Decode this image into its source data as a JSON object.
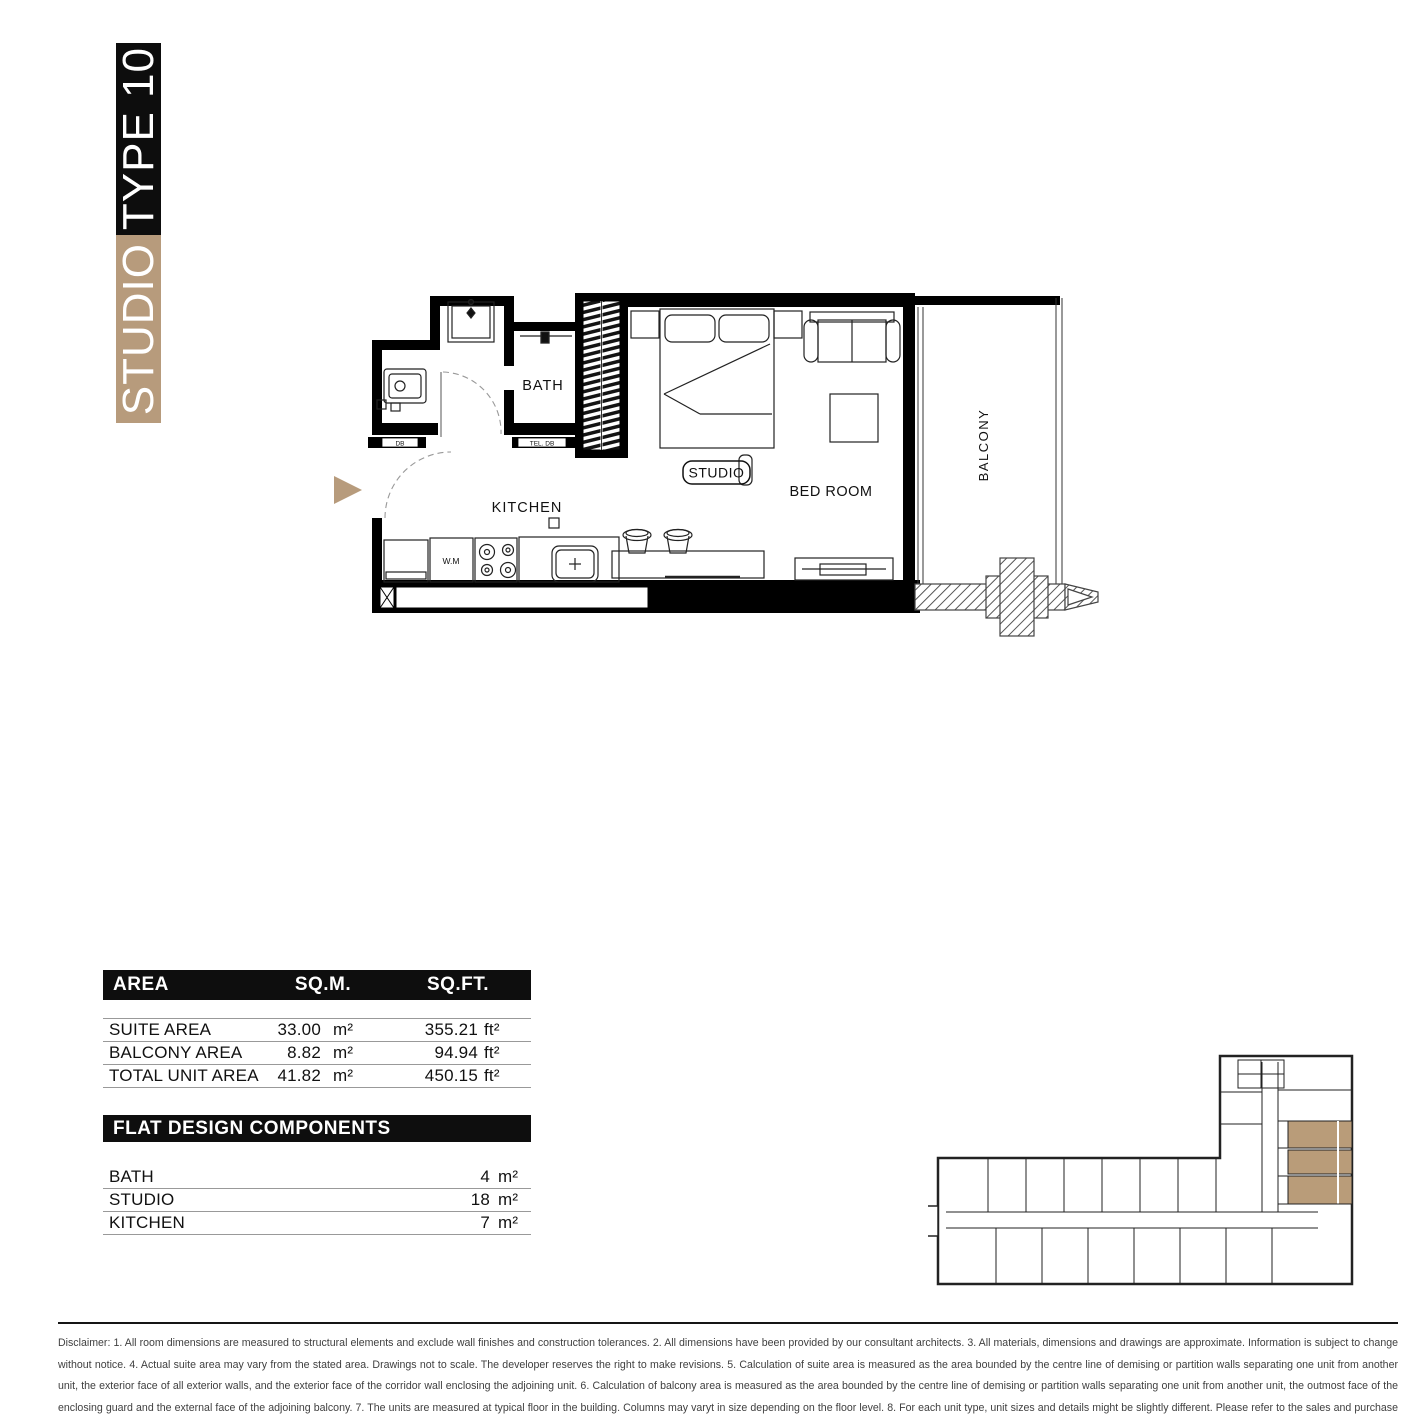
{
  "banner": {
    "top_label": "TYPE 10",
    "bottom_label": "STUDIO"
  },
  "colors": {
    "accent_tan": "#b79b7c",
    "keyplan_highlight": "#b99c79",
    "bar_black": "#0e0e0e"
  },
  "plan": {
    "labels": {
      "bath": "BATH",
      "kitchen": "KITCHEN",
      "studio": "STUDIO",
      "bedroom": "BED ROOM",
      "balcony": "BALCONY",
      "db": "DB",
      "tel_db": "TEL. DB",
      "wm": "W.M"
    }
  },
  "area_table": {
    "header": {
      "area": "AREA",
      "sqm": "SQ.M.",
      "sqft": "SQ.FT."
    },
    "rows": [
      {
        "label": "SUITE AREA",
        "sqm": "33.00",
        "sqm_unit": "m²",
        "sqft": "355.21",
        "sqft_unit": "ft²"
      },
      {
        "label": "BALCONY AREA",
        "sqm": "8.82",
        "sqm_unit": "m²",
        "sqft": "94.94",
        "sqft_unit": "ft²"
      },
      {
        "label": "TOTAL UNIT AREA",
        "sqm": "41.82",
        "sqm_unit": "m²",
        "sqft": "450.15",
        "sqft_unit": "ft²"
      }
    ]
  },
  "components": {
    "title": "FLAT DESIGN COMPONENTS",
    "rows": [
      {
        "label": "BATH",
        "value": "4",
        "unit": "m²"
      },
      {
        "label": "STUDIO",
        "value": "18",
        "unit": "m²"
      },
      {
        "label": "KITCHEN",
        "value": "7",
        "unit": "m²"
      }
    ]
  },
  "disclaimer": {
    "text": "Disclaimer: 1. All room dimensions are measured to structural elements and exclude wall finishes and construction tolerances. 2. All dimensions have been provided by our consultant architects. 3. All materials, dimensions and drawings are approximate. Information is subject to change without notice. 4. Actual suite area may vary from the stated area. Drawings not to scale. The developer reserves the right to make revisions. 5. Calculation of suite area is measured as the area bounded by the centre line of demising or partition walls separating one unit from another unit, the exterior face of all exterior walls, and the exterior face of the corridor wall enclosing the adjoining unit. 6. Calculation of balcony area is measured as the area bounded by the centre line of demising or partition walls separating one unit from another unit, the outmost face of the enclosing guard and the external face of the adjoining balcony. 7. The units are measured at typical floor in the building. Columns may varyt in size depending on the floor level. 8. For each unit type, unit sizes and details might be slightly different. Please refer to the sales and purchase agreement for the actual size of each specific unit."
  }
}
